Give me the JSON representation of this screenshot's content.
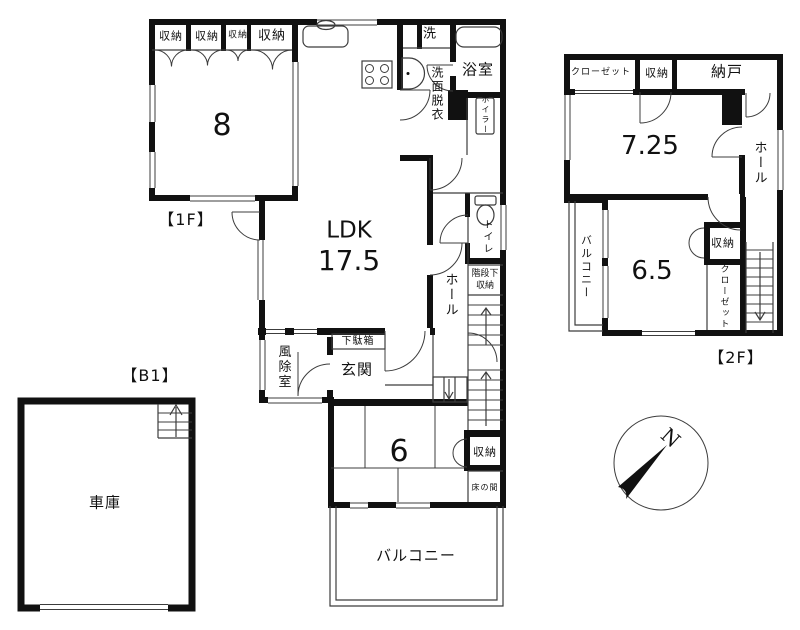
{
  "floor_1f": {
    "label": "【1F】",
    "closet1": "収納",
    "closet2": "収納",
    "closet3": "収納",
    "closet4": "収納",
    "room8": "8",
    "laundry": "洗",
    "bath": "浴室",
    "washroom": "洗面脱衣",
    "boiler": "ボイラー",
    "ldk": "LDK",
    "ldk_size": "17.5",
    "toilet": "トイレ",
    "hall": "ホール",
    "under_stair_1": "階段下",
    "under_stair_2": "収納",
    "shoe_cabinet": "下駄箱",
    "entrance": "玄関",
    "windbreak": "風除室",
    "room6": "6",
    "storage": "収納",
    "tokonoma": "床の間",
    "balcony": "バルコニー"
  },
  "floor_2f": {
    "label": "【2F】",
    "closet_top": "クローゼット",
    "storage_top": "収納",
    "nando": "納戸",
    "room725": "7.25",
    "hall": "ホール",
    "balcony": "バルコニー",
    "room65": "6.5",
    "storage": "収納",
    "closet_side": "クローゼット"
  },
  "floor_b1": {
    "label": "【B1】",
    "garage": "車庫"
  },
  "compass": {
    "north_label": "N"
  },
  "colors": {
    "wall": "#111111",
    "thin_line": "#3c3c3c",
    "background": "#ffffff"
  }
}
